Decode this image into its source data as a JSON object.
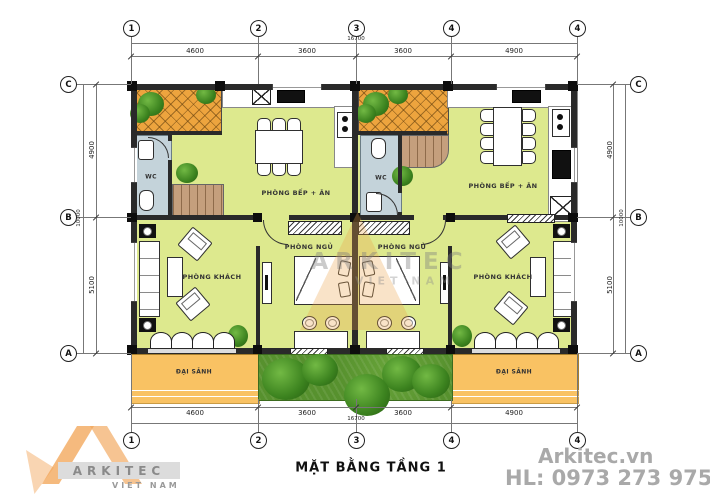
{
  "title": "MẶT BẰNG TẦNG 1",
  "grid": {
    "cols": [
      "1",
      "2",
      "3",
      "4",
      "4"
    ],
    "rows": [
      "C",
      "B",
      "A"
    ]
  },
  "dimensions": {
    "top_total": "16700",
    "top_segments": [
      "4600",
      "3600",
      "3600",
      "4900"
    ],
    "bottom_total": "16700",
    "bottom_segments": [
      "4600",
      "3600",
      "3600",
      "4900"
    ],
    "left_segments": [
      "4900",
      "5100"
    ],
    "left_total": "10000",
    "right_segments": [
      "4900",
      "5100"
    ],
    "right_total": "10000"
  },
  "rooms": {
    "kitchen_left": "PHÒNG BẾP + ĂN",
    "kitchen_right": "PHÒNG BẾP + ĂN",
    "living_left": "PHÒNG KHÁCH",
    "living_right": "PHÒNG KHÁCH",
    "bedroom_left": "PHÒNG NGỦ",
    "bedroom_right": "PHÒNG NGỦ",
    "wc_left": "WC",
    "wc_right": "WC",
    "porch_left": "ĐẠI SẢNH",
    "porch_right": "ĐẠI SẢNH"
  },
  "watermark": {
    "line1": "ARKITEC",
    "line2": "VIET NAM"
  },
  "brand": {
    "logo_text": "ARKITEC",
    "logo_sub": "VIET NAM",
    "website": "Arkitec.vn",
    "hotline": "HL: 0973 273 975"
  },
  "colors": {
    "room_fill": "#dde98e",
    "terrace": "#eda43e",
    "porch": "#f9c263",
    "wc": "#c4d3da",
    "stairs": "#c59f7d",
    "grass": "#57912e",
    "wall": "#2a2a2a",
    "brand_gray": "#a9a9a9"
  }
}
